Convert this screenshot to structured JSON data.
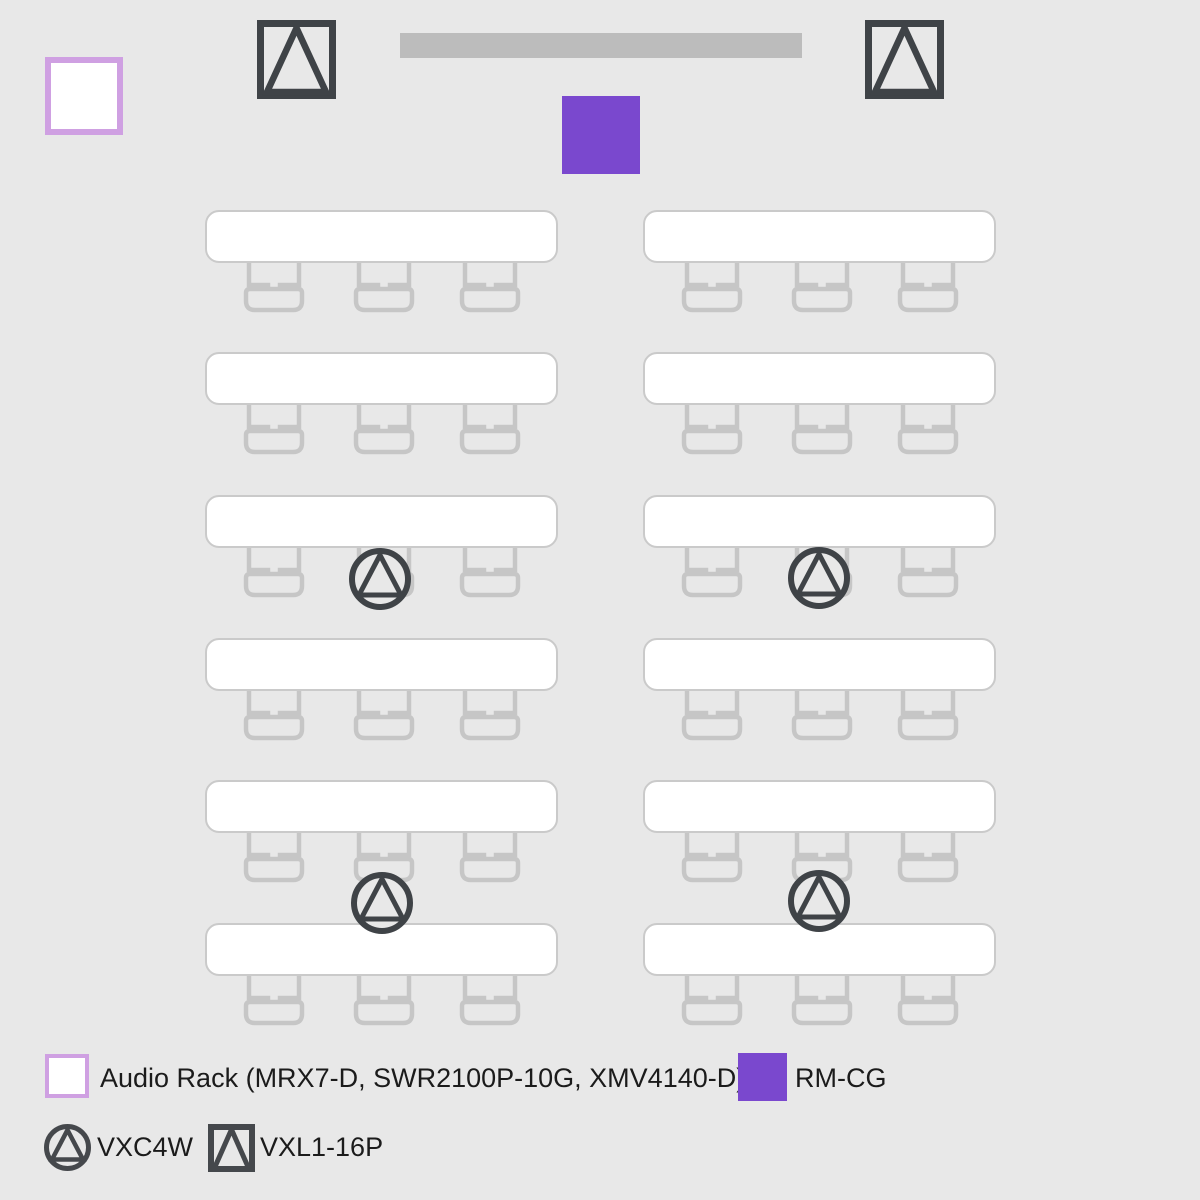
{
  "colors": {
    "background": "#e8e8e8",
    "screen_bar": "#bcbcbc",
    "accent_purple": "#7a48ce",
    "lilac_border": "#cfa0e2",
    "dark_icon": "#3f4347",
    "furniture_stroke": "#c6c6c6",
    "table_border": "#cacaca",
    "table_fill": "#ffffff",
    "text": "#1b1b1b"
  },
  "room": {
    "screen_bar": {
      "x": 400,
      "y": 33,
      "w": 402,
      "h": 25
    },
    "audio_rack": {
      "x": 45,
      "y": 57,
      "size": 78
    },
    "rm_cg": {
      "x": 562,
      "y": 96,
      "size": 78
    },
    "vxl_speakers": [
      {
        "x": 257,
        "y": 20
      },
      {
        "x": 865,
        "y": 20
      }
    ],
    "vxc_speakers": [
      {
        "cx": 380,
        "cy": 579
      },
      {
        "cx": 819,
        "cy": 578
      },
      {
        "cx": 382,
        "cy": 903
      },
      {
        "cx": 819,
        "cy": 901
      }
    ],
    "tables": {
      "width": 353,
      "height": 53,
      "columns_x": [
        205,
        643
      ],
      "rows_y": [
        210,
        352,
        495,
        638,
        780,
        923
      ],
      "chairs_per_table": 3,
      "chair_offsets": [
        69,
        179,
        285
      ]
    }
  },
  "legend": {
    "items": [
      {
        "id": "audio-rack",
        "label": "Audio Rack (MRX7-D, SWR2100P-10G, XMV4140-D)"
      },
      {
        "id": "rm-cg",
        "label": "RM-CG"
      },
      {
        "id": "vxc4w",
        "label": "VXC4W"
      },
      {
        "id": "vxl1-16p",
        "label": "VXL1-16P"
      }
    ]
  }
}
